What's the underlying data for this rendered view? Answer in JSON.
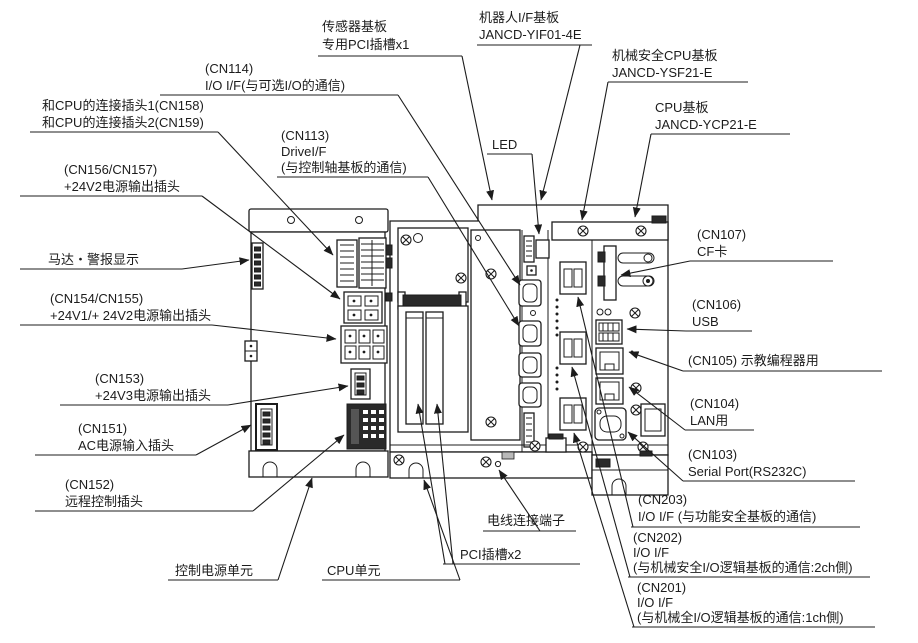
{
  "diagram": {
    "background": "#ffffff",
    "line_color": "#1c1c1c",
    "description_components": [
      "control power unit",
      "CPU unit",
      "robot I/F board",
      "CPU board"
    ]
  },
  "labels": {
    "sensor_board": {
      "l1": "传感器基板",
      "l2": "专用PCI插槽x1"
    },
    "robot_if_board": {
      "l1": "机器人I/F基板",
      "l2": "JANCD-YIF01-4E"
    },
    "safety_cpu_board": {
      "l1": "机械安全CPU基板",
      "l2": "JANCD-YSF21-E"
    },
    "cpu_board": {
      "l1": "CPU基板",
      "l2": "JANCD-YCP21-E"
    },
    "cn114": {
      "l1": "(CN114)",
      "l2": "I/O I/F(与可选I/O的通信)"
    },
    "cn158_cn159": {
      "l1": "和CPU的连接插头1(CN158)",
      "l2": "和CPU的连接插头2(CN159)"
    },
    "cn113": {
      "l1": "(CN113)",
      "l2": "DriveI/F",
      "l3": "(与控制轴基板的通信)"
    },
    "cn156_cn157": {
      "l1": "(CN156/CN157)",
      "l2": "+24V2电源输出插头"
    },
    "motor_alarm": {
      "l1": "马达・警报显示"
    },
    "cn154_cn155": {
      "l1": "(CN154/CN155)",
      "l2": "+24V1/+ 24V2电源输出插头"
    },
    "cn153": {
      "l1": "(CN153)",
      "l2": "+24V3电源输出插头"
    },
    "cn151": {
      "l1": "(CN151)",
      "l2": "AC电源输入插头"
    },
    "cn152": {
      "l1": "(CN152)",
      "l2": "远程控制插头"
    },
    "led": {
      "l1": "LED"
    },
    "cn107": {
      "l1": "(CN107)",
      "l2": "CF卡"
    },
    "cn106": {
      "l1": "(CN106)",
      "l2": "USB"
    },
    "cn105": {
      "l1": "(CN105) 示教编程器用"
    },
    "cn104": {
      "l1": "(CN104)",
      "l2": "LAN用"
    },
    "cn103": {
      "l1": "(CN103)",
      "l2": "Serial Port(RS232C)"
    },
    "cn203": {
      "l1": "(CN203)",
      "l2": "I/O I/F (与功能安全基板的通信)"
    },
    "cn202": {
      "l1": "(CN202)",
      "l2": "I/O I/F",
      "l3": "(与机械安全I/O逻辑基板的通信:2ch側)"
    },
    "cn201": {
      "l1": "(CN201)",
      "l2": "I/O I/F",
      "l3": "(与机械全I/O逻辑基板的通信:1ch側)"
    },
    "wire_terminal": {
      "l1": "电线连接端子"
    },
    "pci_slots": {
      "l1": "PCI插槽x2"
    },
    "cpu_unit": {
      "l1": "CPU单元"
    },
    "control_power_unit": {
      "l1": "控制电源单元"
    }
  }
}
